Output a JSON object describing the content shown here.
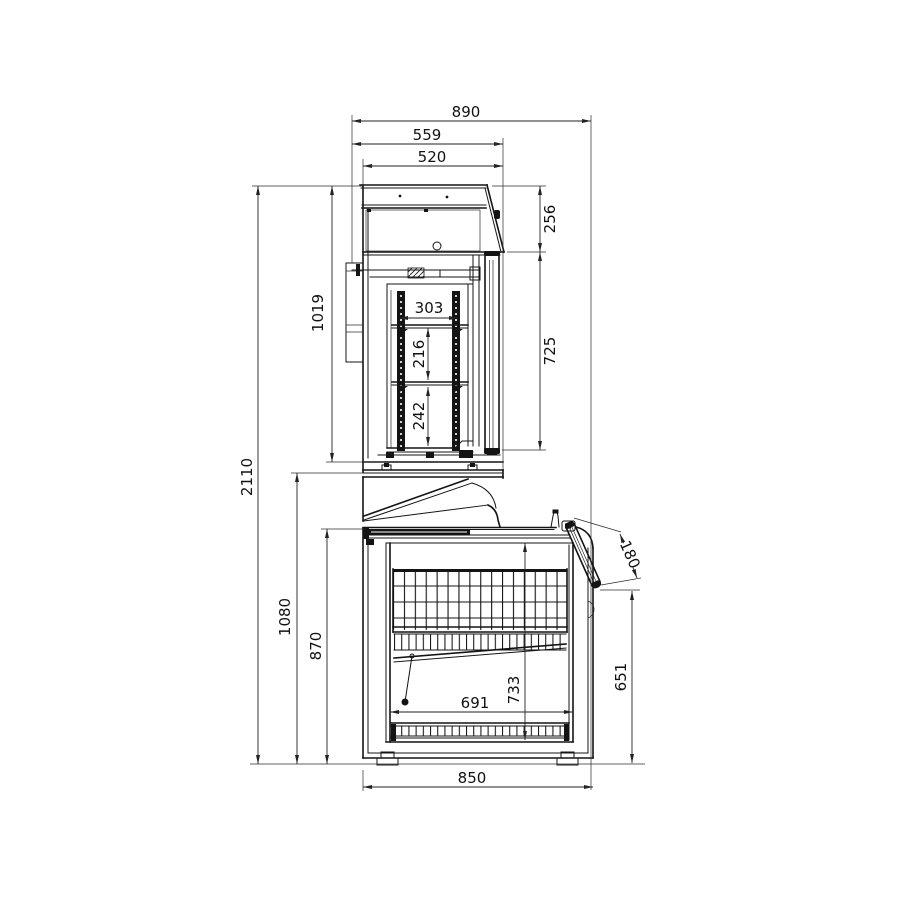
{
  "drawing": {
    "type_label": "side-section technical drawing",
    "line_color": "#141414",
    "background_color": "#ffffff"
  },
  "dimensions": {
    "overall_width": "890",
    "upper_depth_overall": "559",
    "upper_depth_body": "520",
    "upper_front_top_height": "256",
    "upper_door_height": "725",
    "overall_height": "2110",
    "upper_unit_height": "1019",
    "shelf_clear_width": "303",
    "shelf_spacing_mid": "216",
    "shelf_spacing_bottom": "242",
    "counter_top_height": "1080",
    "lower_unit_height": "870",
    "lid_door_width": "180",
    "door_bottom_edge_height": "651",
    "lower_interior_height": "733",
    "lower_interior_depth": "691",
    "lower_body_depth": "850"
  }
}
